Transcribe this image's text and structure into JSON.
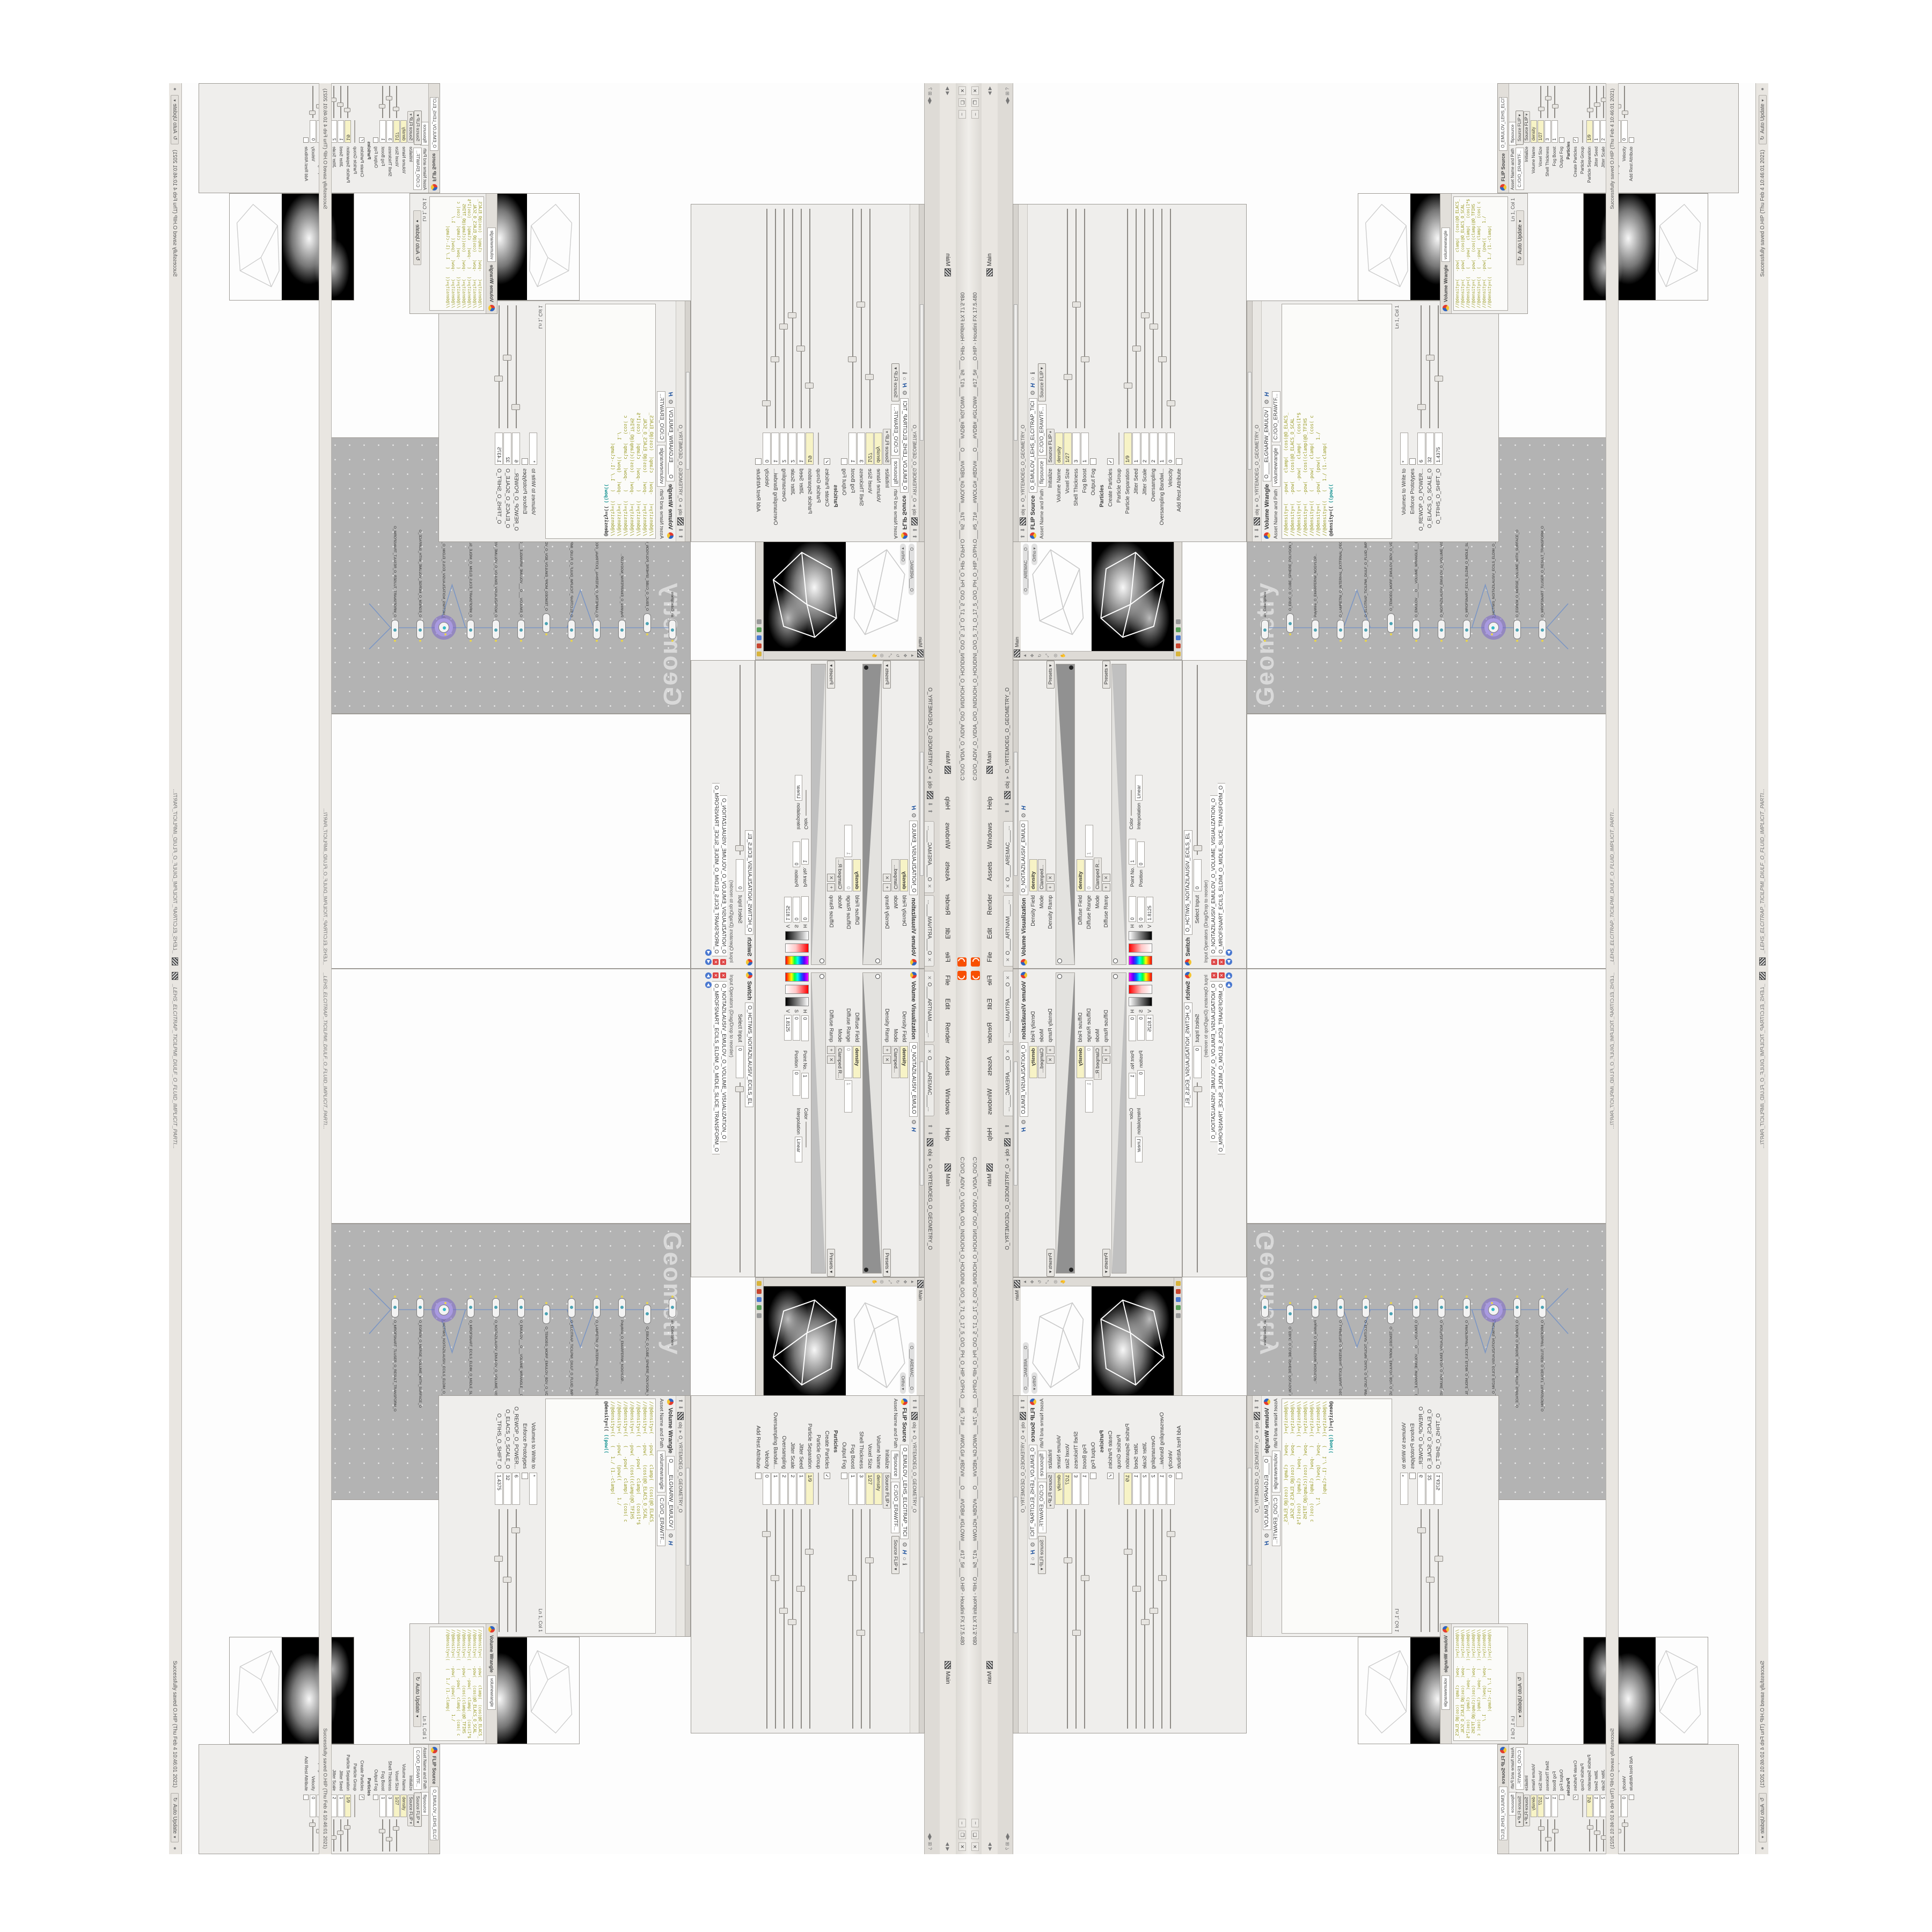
{
  "window": {
    "title": "C:/O/O_ADIV_O_VIDIA_O/O_INIDUOH_O_HOUDINI_O/O_5_71_O_17_5_O/O_PH_O_HIP_O/PH.O___#5_71#___#WOLG#_#BDV#___O___#VDB#_#GLOW#___#17_5#___O.HIP - Houdini FX 17.5.480",
    "menus": [
      "File",
      "Edit",
      "Render",
      "Assets",
      "Windows",
      "Help"
    ],
    "desktop_label": "Main",
    "take_label": "Main",
    "min_btn": "–",
    "max_btn": "❐",
    "close_btn": "✕",
    "logo_color": "#f84f00"
  },
  "tabs": {
    "tab1": "O____ARTNAM____...",
    "tab2": "O____AREMAC____...",
    "context": "obj",
    "geometry_node": "O_YRTEMOEG_O_GEOMETRY_O"
  },
  "flip_source": {
    "title": "FLIP Source",
    "node_name": "O_EMULOV_LEHS_ELCITRAP_TICI",
    "instance_name": "flipsource",
    "asset_label": "Asset Name and Path",
    "asset_path": "C:/O/O_ERAWTF...",
    "preset": "Source FLIP",
    "params": [
      {
        "label": "Initialize",
        "value": "Source FLIP",
        "type": "dropdown"
      },
      {
        "label": "Volume Name",
        "value": "density",
        "type": "field-mod"
      },
      {
        "label": "Voxel Size",
        "value": "1/27",
        "type": "field-mod",
        "slider": 0.22
      },
      {
        "label": "Shell Thickness",
        "value": "3",
        "type": "field",
        "slider": 0.55
      },
      {
        "label": "Fog Boost",
        "value": "1",
        "type": "field",
        "slider": 0.3
      },
      {
        "label": "Output Fog",
        "value": "",
        "type": "check-off"
      },
      {
        "label": "Particles",
        "value": "",
        "type": "section"
      },
      {
        "label": "Create Particles",
        "value": "",
        "type": "check-on"
      },
      {
        "label": "Particle Group",
        "value": "",
        "type": "field"
      },
      {
        "label": "Particle Separation",
        "value": "1/9",
        "type": "field-mod",
        "slider": 0.18
      },
      {
        "label": "Jitter Seed",
        "value": "1",
        "type": "field",
        "slider": 0.35
      },
      {
        "label": "Jitter Scale",
        "value": "2",
        "type": "field",
        "slider": 0.5
      },
      {
        "label": "Oversampling",
        "value": "2",
        "type": "field",
        "slider": 0.45
      },
      {
        "label": "Oversampling Bandwi...",
        "value": "1",
        "type": "field",
        "slider": 0.3
      },
      {
        "label": "Velocity",
        "value": "0",
        "type": "field",
        "slider": 0.1
      },
      {
        "label": "Add Rest Attribute",
        "value": "",
        "type": "check-off"
      }
    ]
  },
  "volume_wrangle": {
    "title": "Volume Wrangle",
    "node_name": "O____ELGNARW_EMULOV",
    "instance_name": "volumewrangle",
    "asset_label": "Asset Name and Path",
    "asset_path": "C:/O/O_ERAWTF...",
    "code": [
      "//@density=(   -pow(   clamp(  (cos(@O_ELACS_",
      "//@density=(   -pow(   (cos(@O_ELACS_O_SCAL",
      "//@density=((   (   -pow(   clamp(   (cos(1*$",
      "//@density=(   -pow(   (cos((clamp(@O_TFIHS",
      "//@density=((   (   -pow(   clamp(   (cos( c",
      "//@density=(   -pow(   (pow((      1./",
      "//@density=((   (   1./ (1.-clamp("
    ],
    "live_line_a": "@density=(( ",
    "live_line_b": "((pow((",
    "volumes_label": "Volumes to Write to",
    "volumes_value": "*",
    "enforce_label": "Enforce Prototypes",
    "line_col": "Ln 1, Col 1",
    "spares": [
      {
        "label": "O_REWOP_O_POWER...",
        "value": "6",
        "type": "field",
        "slider": 0.15
      },
      {
        "label": "O_ELACS_O_SCALE_O",
        "value": "32",
        "type": "field",
        "slider": 0.55
      },
      {
        "label": "O_TFIHS_O_SHIFT_O",
        "value": "1.4375",
        "type": "field",
        "slider": 0.38
      }
    ]
  },
  "volume_visualization": {
    "title": "Volume Visualization",
    "node_name": "O_NOITAZILAUSIV_EMULO",
    "density_field_label": "Density Field",
    "density_field_value": "density",
    "mode1_label": "Mode",
    "mode1_value": "Clamped...",
    "density_ramp_label": "Density Ramp",
    "presets_label": "Presets",
    "diffuse_field_label": "Diffuse Field",
    "diffuse_field_value": "density",
    "diffuse_range_label": "Diffuse Range",
    "diffuse_range_min": "0",
    "diffuse_range_max": "1",
    "mode2_label": "Mode",
    "mode2_value": "Clamped R...",
    "diffuse_ramp_label": "Diffuse Ramp",
    "hsv": {
      "h_label": "H",
      "h": "0",
      "s_label": "S",
      "s": "0",
      "v_label": "V",
      "v": "1.8125"
    },
    "point_no_label": "Point No.",
    "point_no": "1",
    "position_label": "Position",
    "position": "0",
    "color_label": "Color",
    "interp_label": "Interpolation",
    "interp_value": "Linear"
  },
  "switch_pane": {
    "title": "Switch",
    "node_name": "O_HCTIWS_NOITAZILAUSIV_ECILS_EL",
    "tab_name": "O_HCTIWS_NOITAZILAUSIV_ECILS_ELDIM_O_MIDLE_SLICE_VISUAL...",
    "select_label": "Select Input",
    "select_value": "0",
    "list_label": "Input Operators (Drag/Drop to reorder)",
    "items": [
      "O_NOITAZILAUSIV_EMULOV_O_VOLUME_VISUALIZATION_O",
      "O_MROFSNART_ECILS_ELDIM_O_MIDLE_SLICE_TRANSFORM_O"
    ]
  },
  "network": {
    "watermark": "Geometry",
    "nodes": [
      "an_CubeSphere",
      "O_EBUC_O_CUBE_SPHERE_POLYGON_WIREFRAME_O",
      "PolyWire_O_EMARFERIW_NOGYLOP...",
      "O_LAMRETNI_O_INTERNAL_EXTERNAL_GEOMETRY_SWITCH_O",
      "O_ELCITRAP_TICILPMI_DIULF_O_FLUID_IMPLICIT_PARTICLE_SHEL_VOLUME_O",
      "O_TEMOEG_MORF_EMULOV_BDV_O_VDB_VOLUME_FROM_GEOMETRY_POLYG",
      "O_EMULOV___O___VOLUME_WRANGLE___02",
      "O_NOITAZILAUSIV_EMULOV_O_VOLUME_VISUALIZATION_O",
      "O_MROFSNART_ECILS_ELDIM_O_MIDLE_SLICE_TRANSFORM_O",
      "O_HCTIWS_NOITAZILAUSIV_ECILS_ELDIM_O_MIDLE_SLICE_VISUALIZATION_SWITCH_O",
      "O_EGREM_O_MERGE_VOLUME_WITH_SURFACE_O",
      "O_MROFSNART_TLUSER_O_RESULT_TRANSFORM_O"
    ]
  },
  "viewport": {
    "tab": "Main",
    "camera": "O____AREMAC____O",
    "view_mode": "Ortho"
  },
  "status": {
    "message": "_LEHS_ELCITRAP_TICILPMI_DIULF_O_FLUID_IMPLICIT_PARTI...",
    "saved": "Successfully saved O.HIP (Thu Feb 4 10:46:01 2021)",
    "auto_update": "Auto Update"
  }
}
